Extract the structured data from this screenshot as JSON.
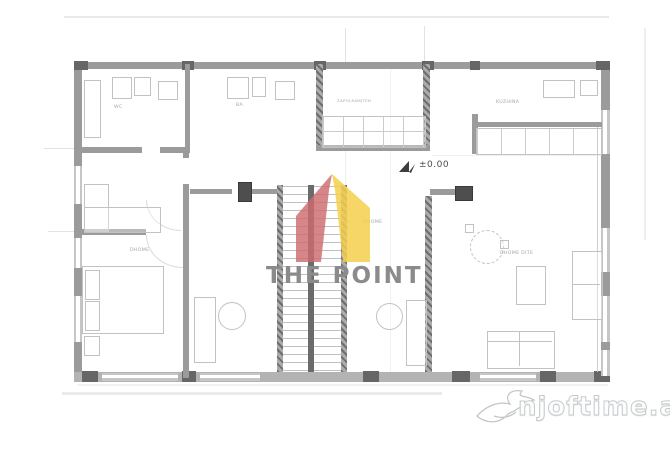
{
  "scan": {
    "type": "floor-plan"
  },
  "logo": {
    "title": "THE POINT",
    "red": "#cd6a6e",
    "yellow": "#f5cf4b",
    "text_color": "#8b8b8d"
  },
  "site_watermark": {
    "text": "njoftime.al"
  },
  "plan": {
    "level_marker": "±0.00",
    "rooms": {
      "wc": "WC",
      "bath": "BA",
      "closet": "ZAPOLEAMJTEN",
      "kitchen": "KUZHINA",
      "bedroom_left": "DHOME",
      "bedroom_middle": "DHOME",
      "living_room": "DHOME DITE"
    }
  },
  "colors": {
    "wall": "#9b9b9b"
  }
}
